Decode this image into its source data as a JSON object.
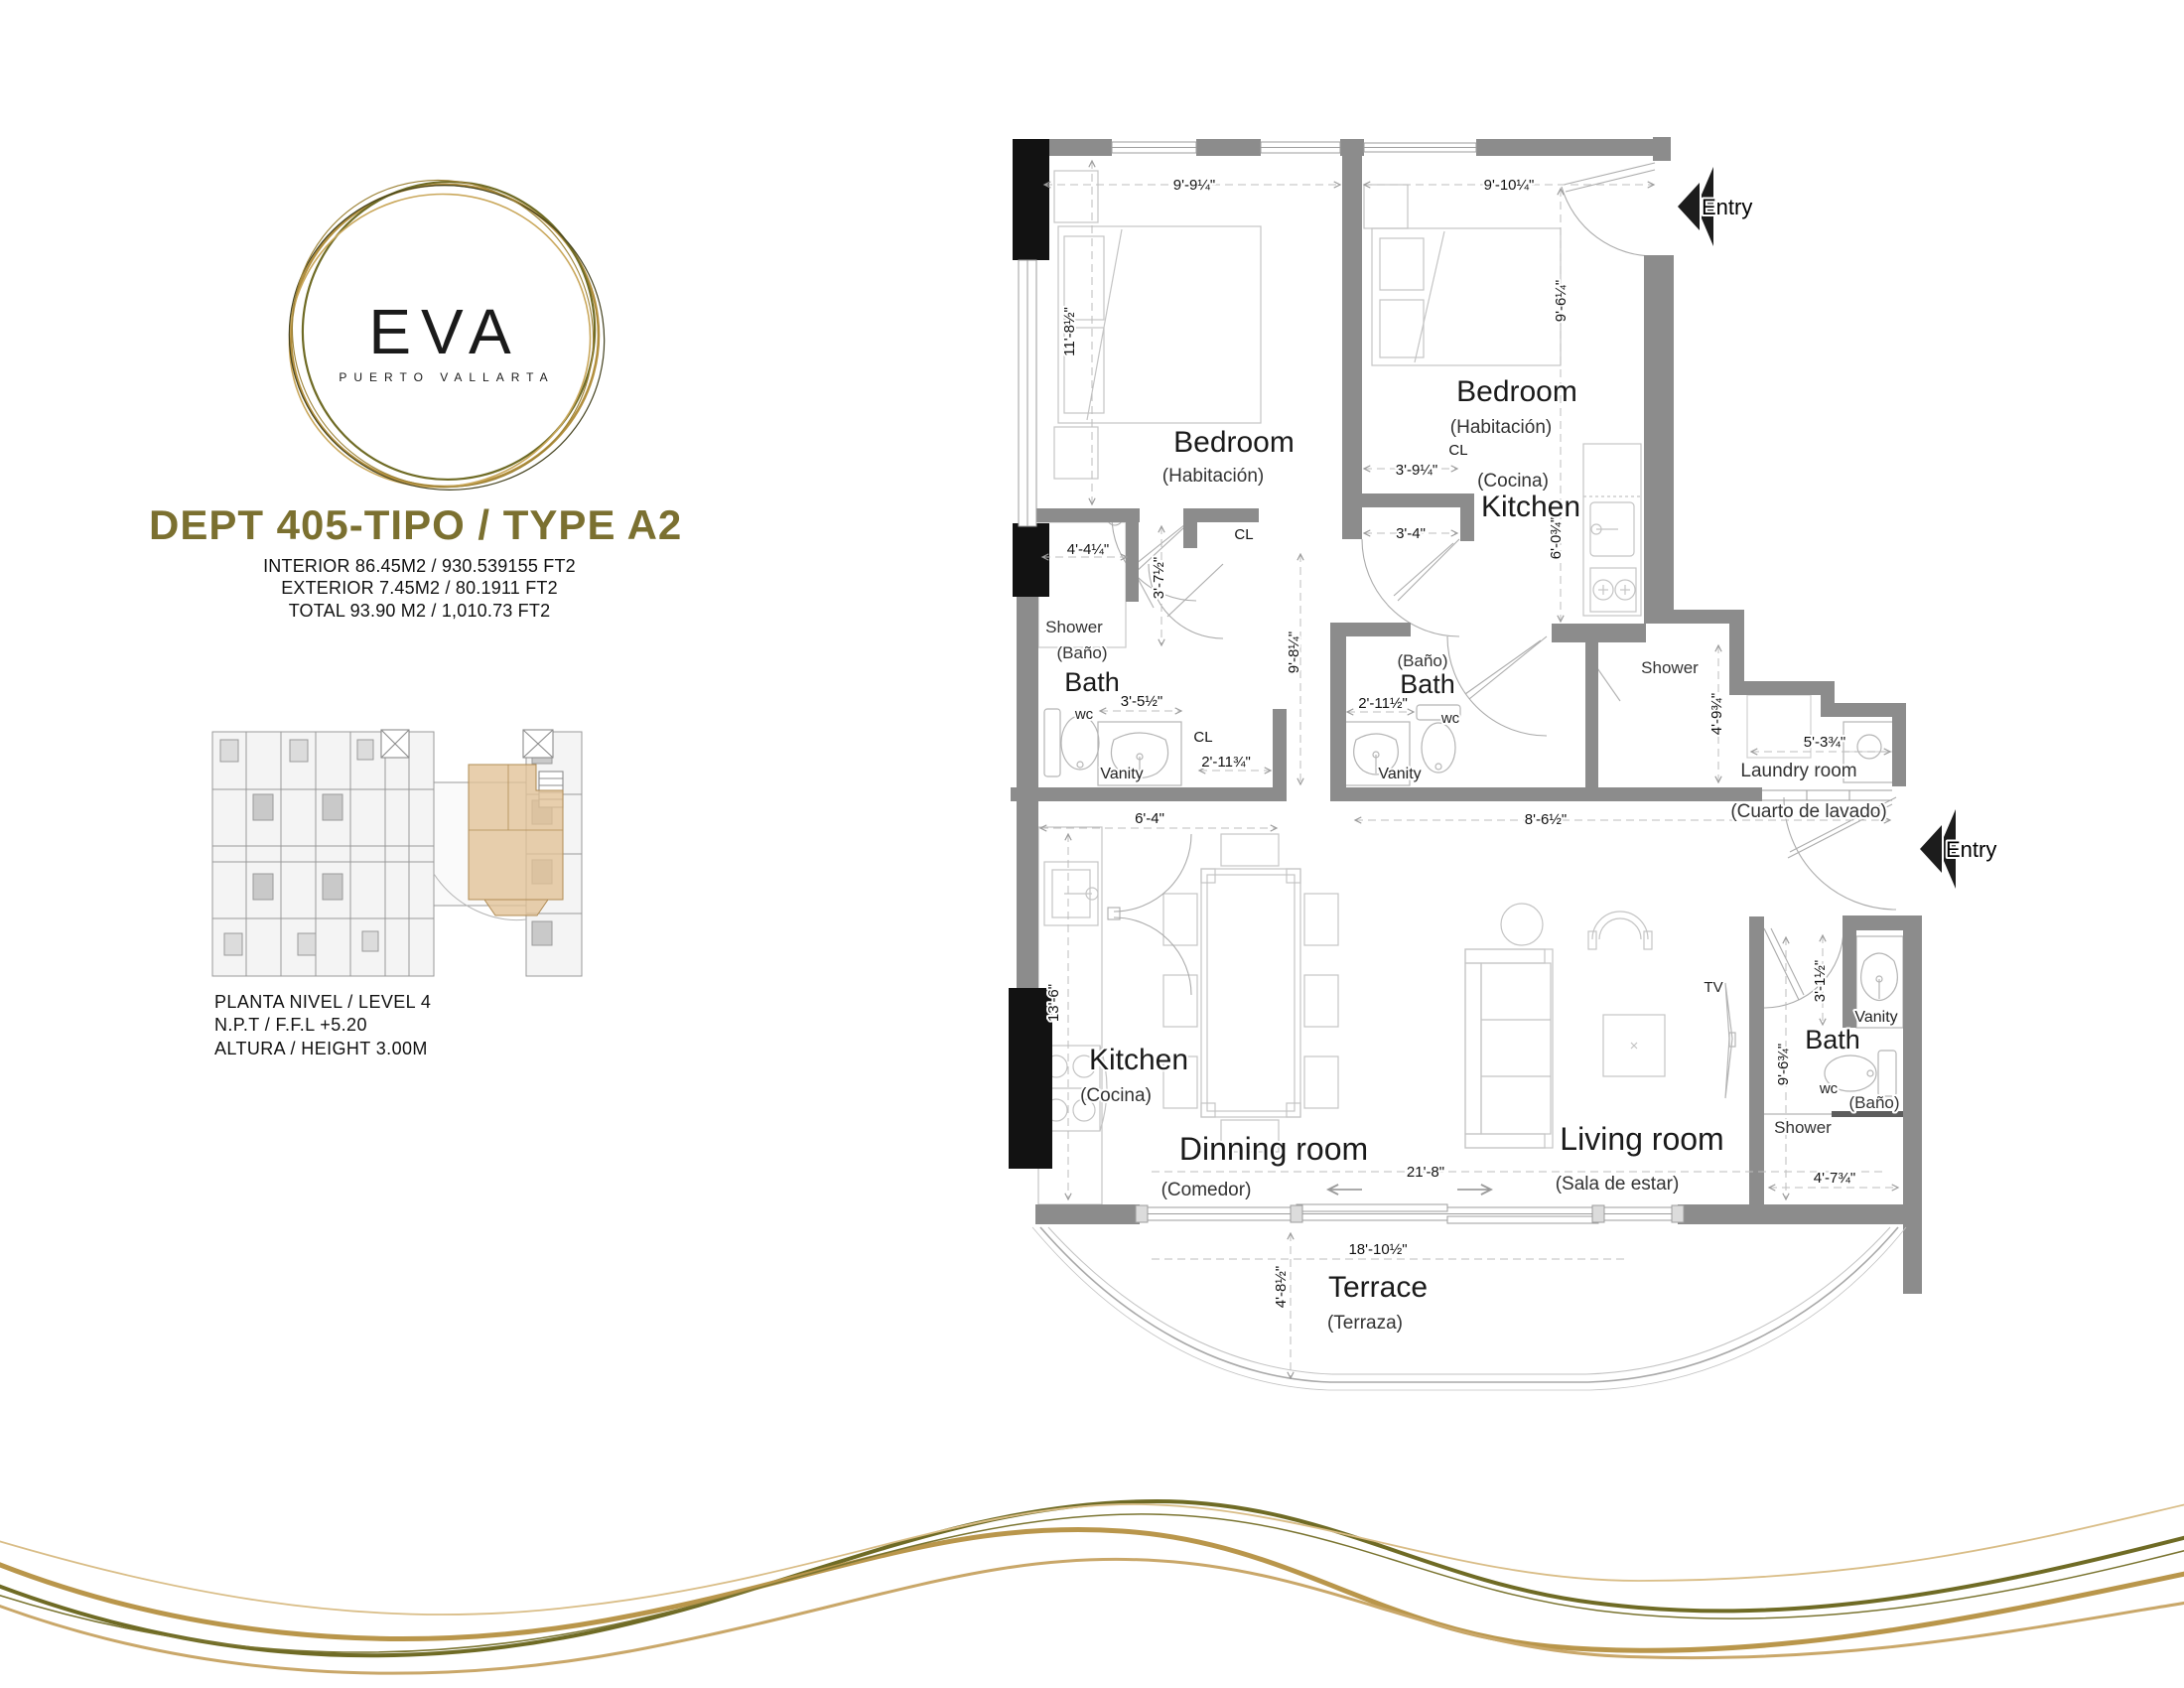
{
  "brand": {
    "name": "EVA",
    "tagline": "PUERTO VALLARTA"
  },
  "unit": {
    "title": "DEPT 405-TIPO / TYPE A2",
    "interior": "INTERIOR  86.45M2 / 930.539155 FT2",
    "exterior": "EXTERIOR 7.45M2 / 80.1911 FT2",
    "total": "TOTAL 93.90 M2 / 1,010.73 FT2"
  },
  "level": {
    "line1": "PLANTA NIVEL / LEVEL 4",
    "line2": "N.P.T / F.F.L +5.20",
    "line3": "ALTURA / HEIGHT 3.00M"
  },
  "colors": {
    "accent_olive": "#7b7030",
    "accent_gold": "#b9964b",
    "wall_gray": "#8c8c8c",
    "column_black": "#121212",
    "highlight_tan": "#e2c296"
  },
  "plan": {
    "rooms": {
      "bedroom1": {
        "en": "Bedroom",
        "es": "(Habitación)"
      },
      "bedroom2": {
        "en": "Bedroom",
        "es": "(Habitación)"
      },
      "kitchen1": {
        "en": "Kitchen",
        "es": "(Cocina)"
      },
      "kitchen2": {
        "en": "Kitchen",
        "es": "(Cocina)"
      },
      "bath1": {
        "en": "Bath",
        "es": "(Baño)"
      },
      "bath2": {
        "en": "Bath",
        "es": "(Baño)"
      },
      "bath3": {
        "en": "Bath",
        "es": "(Baño)"
      },
      "laundry": {
        "en": "Laundry room",
        "es": "(Cuarto de lavado)"
      },
      "dining": {
        "en": "Dinning room",
        "es": "(Comedor)"
      },
      "living": {
        "en": "Living room",
        "es": "(Sala de estar)"
      },
      "terrace": {
        "en": "Terrace",
        "es": "(Terraza)"
      }
    },
    "fixtures": {
      "wc": "wc",
      "vanity": "Vanity",
      "shower": "Shower",
      "closet": "CL",
      "tv": "TV"
    },
    "entry_label": "Entry",
    "dims": {
      "bed1_w": "9'-9¼\"",
      "bed2_w": "9'-10¼\"",
      "bed1_h": "11'-8½\"",
      "bed2_h": "9'-6¼\"",
      "cl2_w": "3'-9¼\"",
      "hall_open": "3'-4\"",
      "sh1_w": "4'-4¼\"",
      "sh1_h": "3'-7½\"",
      "k2_h": "6'-0¾\"",
      "hall_h": "9'-8¼\"",
      "van1_w": "3'-5½\"",
      "cl1_w": "2'-11¾\"",
      "b2_w": "2'-11½\"",
      "sh2_h": "4'-9¾\"",
      "laun_w": "5'-3¾\"",
      "hall2_w": "8'-6½\"",
      "k1_w": "6'-4\"",
      "k1_h": "13'-6\"",
      "b3_van": "3'-1½\"",
      "b3_h": "9'-6¾\"",
      "b3_w": "4'-7¾\"",
      "liv_w": "21'-8\"",
      "ter_w": "18'-10½\"",
      "ter_h": "4'-8½\""
    }
  }
}
